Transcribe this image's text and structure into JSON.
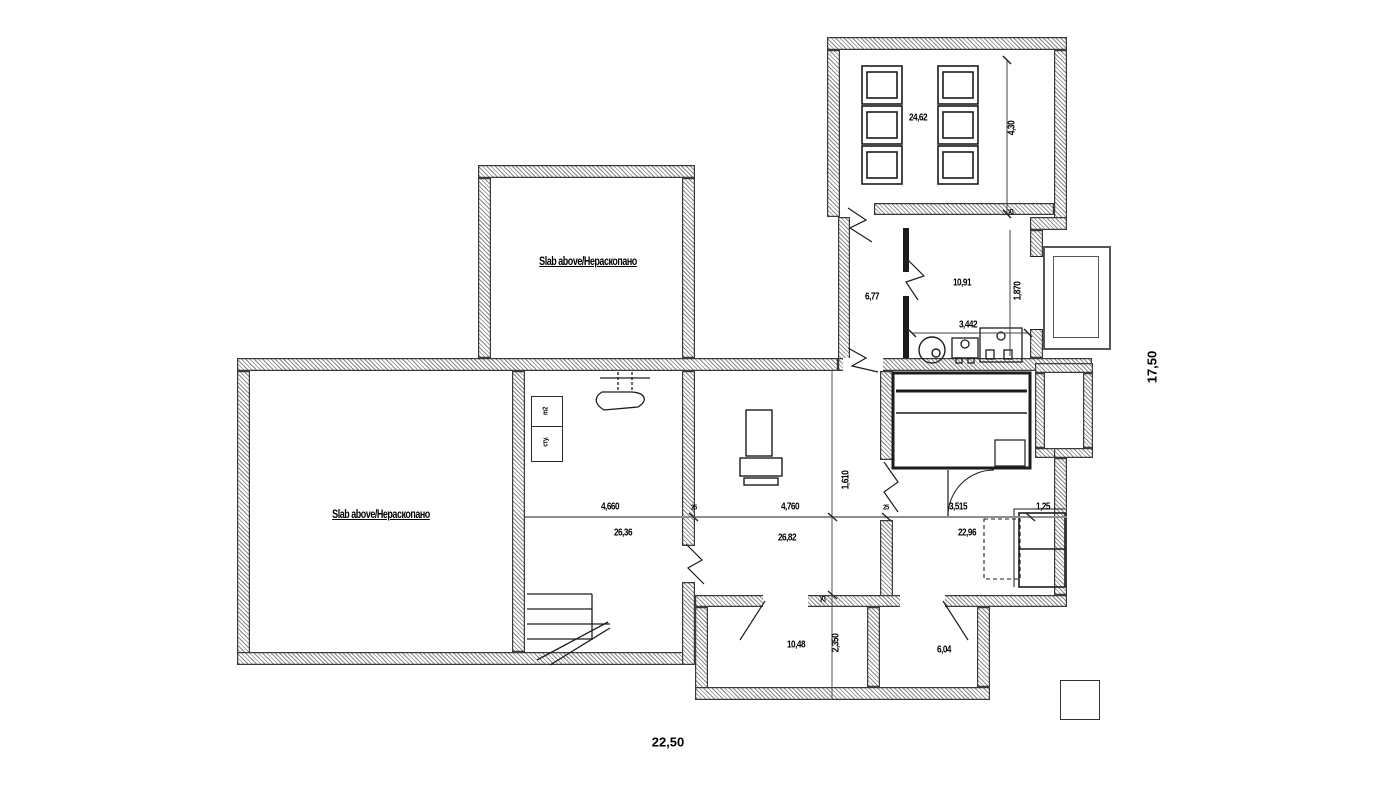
{
  "plan": {
    "room_labels": {
      "slab_top": "Slab above/Нераскопано",
      "slab_left": "Slab above/Нераскопано"
    },
    "areas": {
      "storage": "24,62",
      "corridor": "6,77",
      "bathroom": "10,91",
      "stairs_room": "26,36",
      "central": "26,82",
      "bedroom": "22,96",
      "bottom_middle": "10,48",
      "bottom_right": "6,04"
    },
    "dimensions": {
      "overall_width": "22,50",
      "overall_height": "17,50",
      "storage_depth": "4,30",
      "bathroom_width": "3,442",
      "bathroom_height": "1,870",
      "stairs_room_width": "4,660",
      "central_width": "4,760",
      "bedroom_width": "3,515",
      "bed_width": "1,25",
      "central_height": "1,610",
      "bottom_room_height": "2,350",
      "wall_thickness": "25"
    },
    "legend": {
      "cell_top": "m2",
      "cell_bottom": "сту."
    }
  },
  "colors": {
    "line": "#1c1c1c",
    "wall_hatch": "#8a8a8a",
    "dim_line": "#8f8f8f"
  }
}
